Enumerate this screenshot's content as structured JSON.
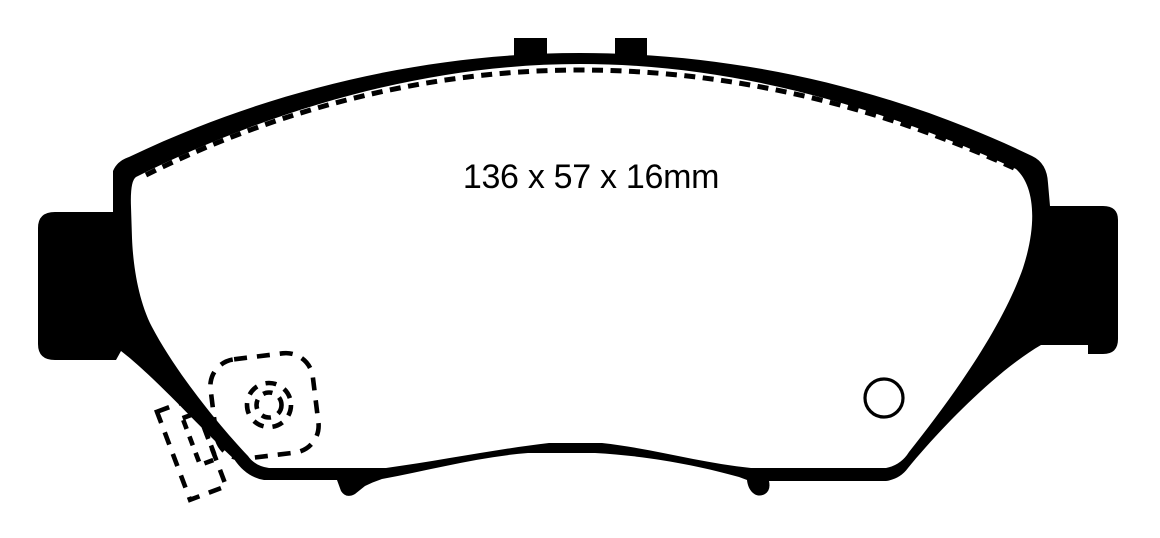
{
  "figure": {
    "dimension_label": "136 x 57 x 16mm",
    "line_color": "#000000",
    "background_color": "#ffffff"
  }
}
